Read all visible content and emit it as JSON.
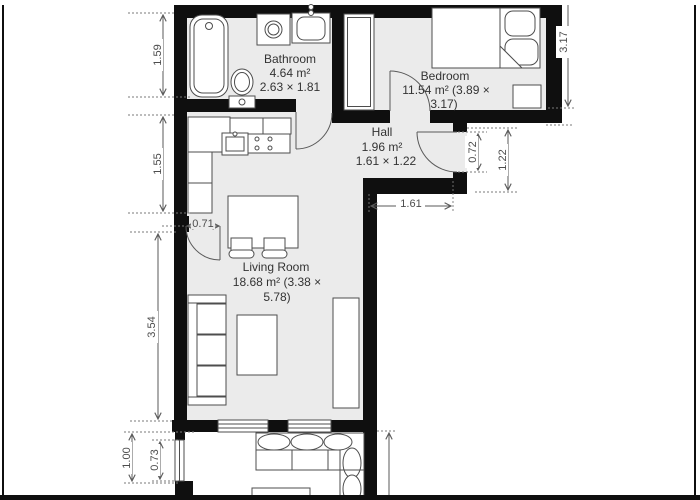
{
  "floorplan": {
    "rooms": [
      {
        "id": "bathroom",
        "label_lines": [
          "Bathroom",
          "4.64 m²",
          "2.63 × 1.81"
        ]
      },
      {
        "id": "bedroom",
        "label_lines": [
          "Bedroom",
          "11.54 m² (3.89 ×",
          "3.17)"
        ]
      },
      {
        "id": "hall",
        "label_lines": [
          "Hall",
          "1.96 m²",
          "1.61 × 1.22"
        ]
      },
      {
        "id": "living-room",
        "label_lines": [
          "Living Room",
          "18.68 m² (3.38 ×",
          "5.78)"
        ]
      }
    ],
    "dimensions": {
      "left": [
        "1.59",
        "1.55",
        "3.54",
        "1.00",
        "0.73"
      ],
      "right": [
        "3.17",
        "0.72",
        "1.22"
      ],
      "bottom": [
        "1.61",
        "0.71"
      ]
    },
    "furniture": [
      "bathtub",
      "washing-machine",
      "bathroom-sink",
      "toilet",
      "wardrobe",
      "double-bed",
      "nightstand",
      "fridge",
      "kitchen-counter",
      "kitchen-sink",
      "stove",
      "dining-table",
      "dining-chairs",
      "sofa",
      "coffee-table",
      "tv-sideboard",
      "balcony-sofa",
      "balcony-table"
    ],
    "colors": {
      "wall": "#0f0f0f",
      "floor": "#ebebeb",
      "furniture_stroke": "#4d4d4d",
      "dimension": "#5a5a5a",
      "label_text": "#333333"
    }
  }
}
